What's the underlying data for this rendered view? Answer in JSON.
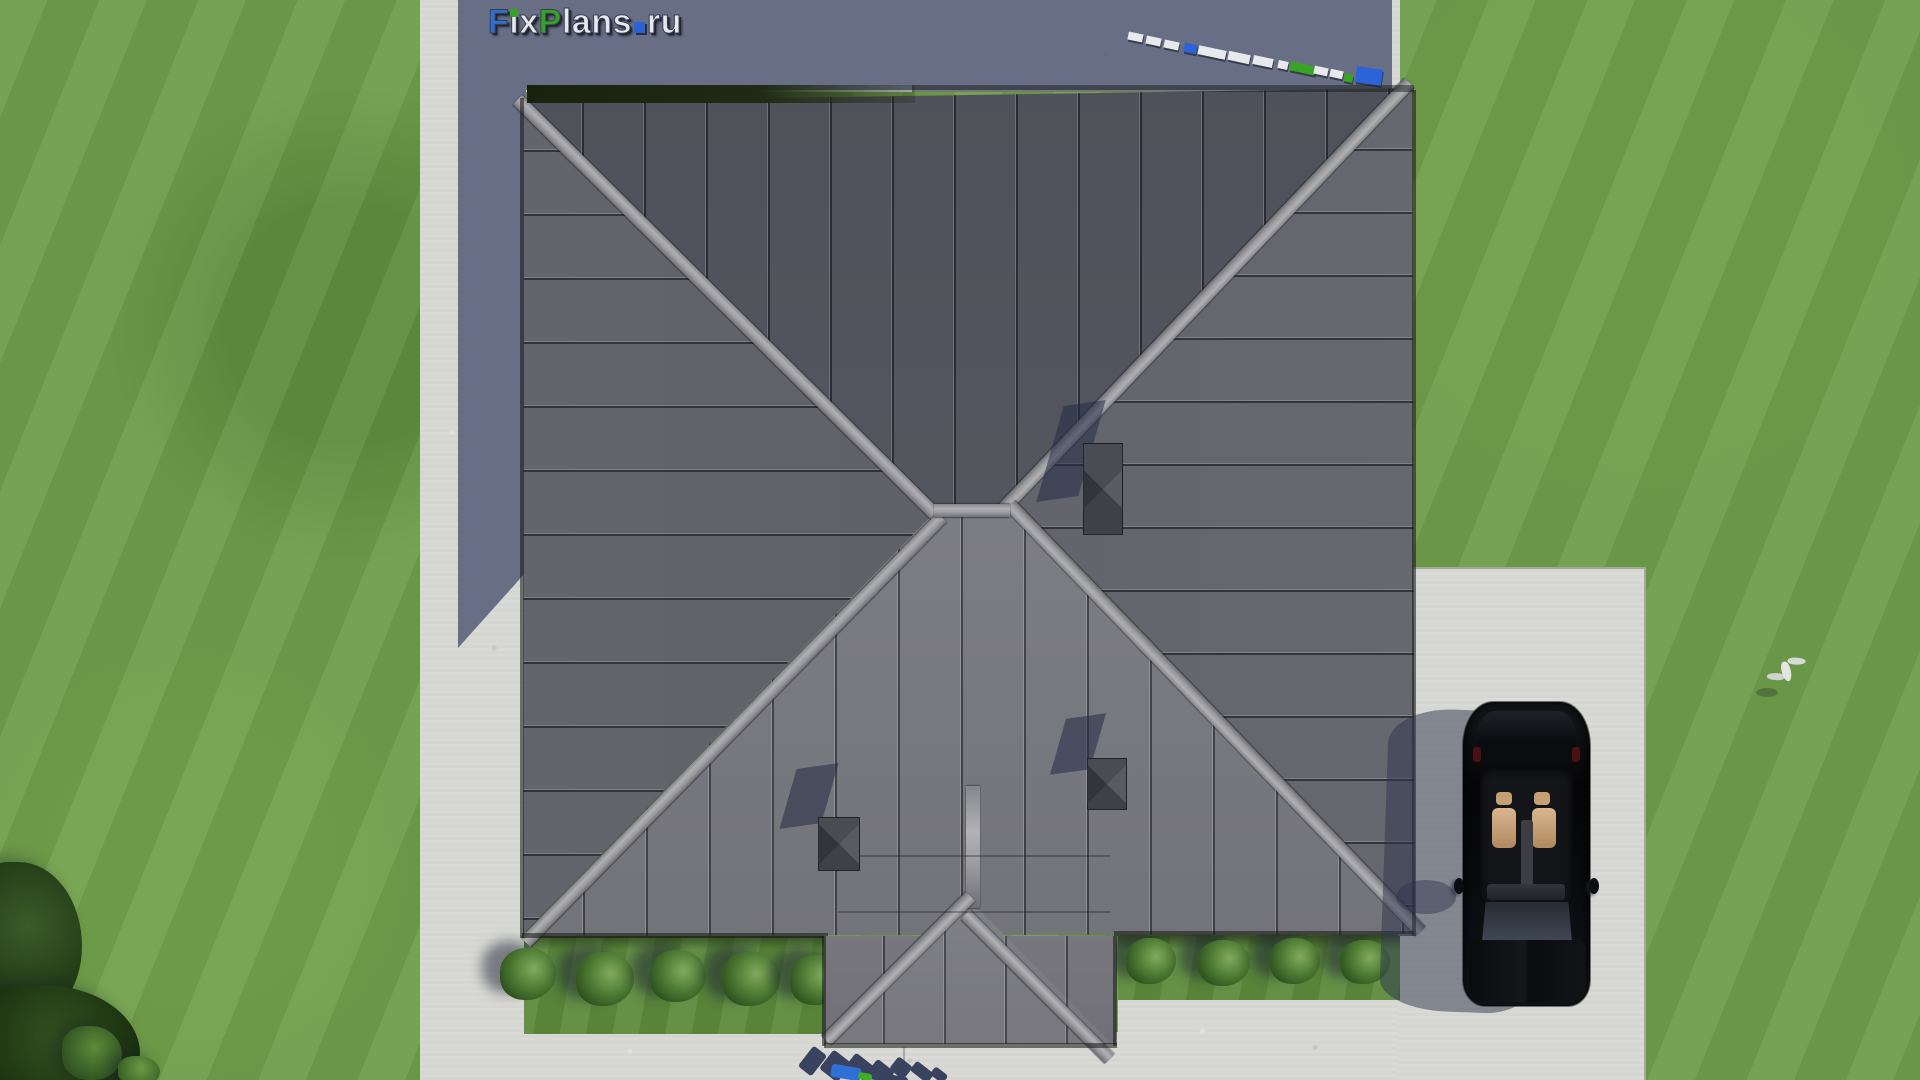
{
  "site": {
    "watermark_text": "FixPlans.ru",
    "view_label": "aerial roof-plan render of a house with hip roof, lawn, driveway and parked car"
  },
  "watermark": {
    "segments": [
      {
        "text": "F",
        "color": "#2e6ed2",
        "shape": "letter"
      },
      {
        "text": "i",
        "color": "#e5e8ef",
        "shape": "letter",
        "dot_color": "#35a423"
      },
      {
        "text": "x",
        "color": "#e5e8ef",
        "shape": "letter"
      },
      {
        "text": "P",
        "color": "#35a423",
        "shape": "letter"
      },
      {
        "text": "lans",
        "color": "#e5e8ef",
        "shape": "letter"
      },
      {
        "text": ".",
        "color": "#2b63d6",
        "shape": "square"
      },
      {
        "text": "ru",
        "color": "#e5e8ef",
        "shape": "letter"
      }
    ]
  },
  "palette": {
    "grass": "#6f9e4a",
    "concrete": "#d8d9d4",
    "house_shadow": "#58607a",
    "roof_north": "#54565e",
    "roof_east": "#636469",
    "roof_west": "#5f6066",
    "roof_south": "#7e7e84",
    "ridge": "#a5a5a8",
    "roof_edge_band": "#1c2613",
    "chimney": "#4a4c55",
    "logo_blue": "#2e6ed2",
    "logo_green": "#35a423",
    "logo_silver": "#e5e8ef",
    "car_black": "#0a0b0e",
    "car_seats": "#d0a87e"
  },
  "scene": {
    "topright_blocks": [
      {
        "x": 1128,
        "y": 33,
        "w": 15,
        "h": 8,
        "c": "#e8e9ec",
        "r": 12
      },
      {
        "x": 1146,
        "y": 37,
        "w": 15,
        "h": 8,
        "c": "#e8e9ec",
        "r": 12
      },
      {
        "x": 1164,
        "y": 41,
        "w": 15,
        "h": 8,
        "c": "#e8e9ec",
        "r": 12
      },
      {
        "x": 1184,
        "y": 44,
        "w": 13,
        "h": 9,
        "c": "#2b64d8",
        "r": 12
      },
      {
        "x": 1198,
        "y": 48,
        "w": 28,
        "h": 9,
        "c": "#e8e9ec",
        "r": 12
      },
      {
        "x": 1228,
        "y": 53,
        "w": 22,
        "h": 9,
        "c": "#e8e9ec",
        "r": 12
      },
      {
        "x": 1253,
        "y": 57,
        "w": 20,
        "h": 9,
        "c": "#e8e9ec",
        "r": 12
      },
      {
        "x": 1278,
        "y": 61,
        "w": 10,
        "h": 8,
        "c": "#e8e9ec",
        "r": 12
      },
      {
        "x": 1290,
        "y": 64,
        "w": 26,
        "h": 9,
        "c": "#37a424",
        "r": 12
      },
      {
        "x": 1314,
        "y": 67,
        "w": 14,
        "h": 8,
        "c": "#e8e9ec",
        "r": 12
      },
      {
        "x": 1330,
        "y": 70,
        "w": 13,
        "h": 8,
        "c": "#e8e9ec",
        "r": 12
      },
      {
        "x": 1344,
        "y": 74,
        "w": 9,
        "h": 8,
        "c": "#37a424",
        "r": 12
      },
      {
        "x": 1356,
        "y": 68,
        "w": 26,
        "h": 16,
        "c": "#2b64d8",
        "r": 8
      }
    ],
    "bottom_fragments": [
      {
        "x": 804,
        "y": 1048,
        "w": 17,
        "h": 26,
        "c": "#39425e",
        "r": 38
      },
      {
        "x": 824,
        "y": 1054,
        "w": 23,
        "h": 24,
        "c": "#39425e",
        "r": 38
      },
      {
        "x": 848,
        "y": 1058,
        "w": 24,
        "h": 18,
        "c": "#39425e",
        "r": 38
      },
      {
        "x": 871,
        "y": 1064,
        "w": 22,
        "h": 14,
        "c": "#39425e",
        "r": 38
      },
      {
        "x": 892,
        "y": 1060,
        "w": 18,
        "h": 16,
        "c": "#39425e",
        "r": 38
      },
      {
        "x": 911,
        "y": 1066,
        "w": 22,
        "h": 12,
        "c": "#39425e",
        "r": 38
      },
      {
        "x": 931,
        "y": 1070,
        "w": 16,
        "h": 10,
        "c": "#39425e",
        "r": 38
      },
      {
        "x": 866,
        "y": 1074,
        "w": 42,
        "h": 8,
        "c": "#39425e",
        "r": 10
      },
      {
        "x": 831,
        "y": 1066,
        "w": 30,
        "h": 13,
        "c": "#2f6fd6",
        "r": 10
      },
      {
        "x": 858,
        "y": 1073,
        "w": 14,
        "h": 7,
        "c": "#3fae2a",
        "r": 10
      }
    ],
    "bushes_left": [
      {
        "x": 500,
        "y": 948,
        "w": 56,
        "h": 52
      },
      {
        "x": 576,
        "y": 952,
        "w": 58,
        "h": 54
      },
      {
        "x": 650,
        "y": 950,
        "w": 56,
        "h": 52
      },
      {
        "x": 722,
        "y": 952,
        "w": 58,
        "h": 54
      },
      {
        "x": 790,
        "y": 955,
        "w": 54,
        "h": 50
      }
    ],
    "bushes_right": [
      {
        "x": 1126,
        "y": 938,
        "w": 50,
        "h": 46
      },
      {
        "x": 1198,
        "y": 940,
        "w": 52,
        "h": 46
      },
      {
        "x": 1270,
        "y": 938,
        "w": 50,
        "h": 46
      },
      {
        "x": 1340,
        "y": 940,
        "w": 50,
        "h": 44
      }
    ],
    "trees": [
      {
        "x": -38,
        "y": 862,
        "w": 120,
        "h": 160,
        "c1": "#3a5c28",
        "c2": "#1d3413"
      },
      {
        "x": -45,
        "y": 985,
        "w": 185,
        "h": 130,
        "c1": "#33531f",
        "c2": "#16290e"
      },
      {
        "x": 62,
        "y": 1026,
        "w": 60,
        "h": 54,
        "c1": "#5c8a3a",
        "c2": "#2f5220"
      },
      {
        "x": 118,
        "y": 1056,
        "w": 42,
        "h": 30,
        "c1": "#6b9a46",
        "c2": "#3a6326"
      }
    ]
  }
}
